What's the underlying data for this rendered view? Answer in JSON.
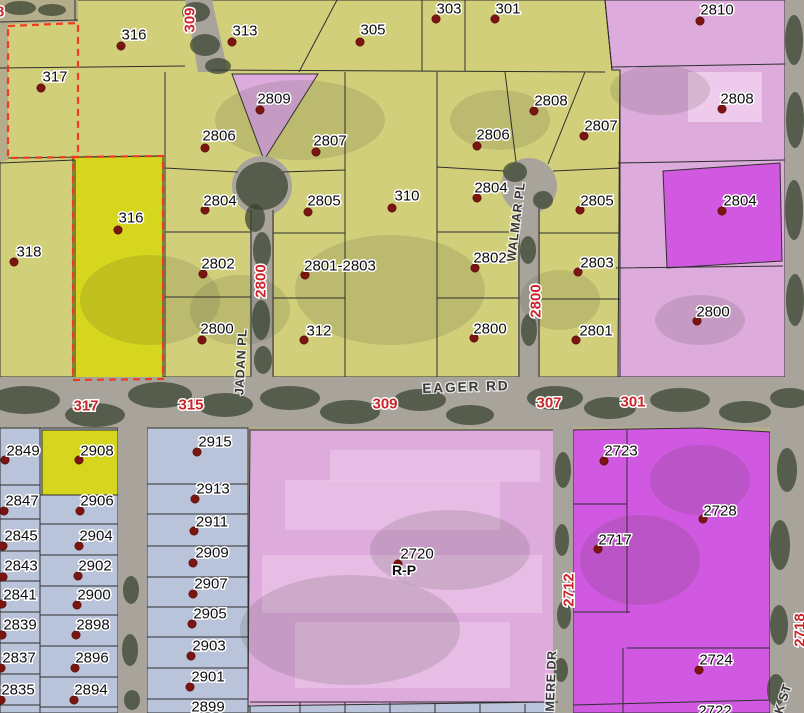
{
  "map": {
    "type": "gis-parcel-zoning-map",
    "colors": {
      "yellow": "#d2cf7b",
      "bright-yellow": "#d5d61d",
      "pink": "#ddabdc",
      "light-pink": "#eecaec",
      "magenta": "#d158e0",
      "blue": "#b9c3d9",
      "road": "#a8a39b",
      "ground": "#b3ad8c",
      "tree": "#37422e",
      "boundary": "#2f2f2f",
      "selection": "#f03b22",
      "dot": "#7c1511",
      "label": "#0c0c0c",
      "road-label": "#c9252b",
      "street": "#383838"
    },
    "parcels": [
      {
        "n": "316",
        "c": "y",
        "x": 134,
        "y": 35,
        "dx": 121,
        "dy": 46
      },
      {
        "n": "313",
        "c": "y",
        "x": 245,
        "y": 31,
        "dx": 232,
        "dy": 42
      },
      {
        "n": "305",
        "c": "y",
        "x": 373,
        "y": 30,
        "dx": 360,
        "dy": 42
      },
      {
        "n": "303",
        "c": "y",
        "x": 449,
        "y": 9,
        "dx": 436,
        "dy": 19
      },
      {
        "n": "301",
        "c": "y",
        "x": 508,
        "y": 9,
        "dx": 495,
        "dy": 19
      },
      {
        "n": "317",
        "c": "y",
        "x": 55,
        "y": 77,
        "dx": 41,
        "dy": 88
      },
      {
        "n": "318",
        "c": "y",
        "x": 29,
        "y": 252,
        "dx": 14,
        "dy": 262
      },
      {
        "n": "316",
        "c": "by",
        "x": 131,
        "y": 218,
        "dx": 118,
        "dy": 230
      },
      {
        "n": "2806",
        "c": "y",
        "x": 219,
        "y": 136,
        "dx": 205,
        "dy": 148
      },
      {
        "n": "2809",
        "c": "p",
        "x": 274,
        "y": 99,
        "dx": 260,
        "dy": 110
      },
      {
        "n": "2807",
        "c": "y",
        "x": 330,
        "y": 141,
        "dx": 316,
        "dy": 152
      },
      {
        "n": "2804",
        "c": "y",
        "x": 220,
        "y": 201,
        "dx": 205,
        "dy": 210
      },
      {
        "n": "2805",
        "c": "y",
        "x": 324,
        "y": 201,
        "dx": 308,
        "dy": 212
      },
      {
        "n": "310",
        "c": "y",
        "x": 407,
        "y": 196,
        "dx": 392,
        "dy": 208
      },
      {
        "n": "2802",
        "c": "y",
        "x": 218,
        "y": 264,
        "dx": 203,
        "dy": 274
      },
      {
        "n": "2801-2803",
        "c": "y",
        "x": 340,
        "y": 266,
        "dx": 305,
        "dy": 275
      },
      {
        "n": "2800",
        "c": "y",
        "x": 217,
        "y": 329,
        "dx": 202,
        "dy": 340
      },
      {
        "n": "312",
        "c": "y",
        "x": 319,
        "y": 331,
        "dx": 304,
        "dy": 340
      },
      {
        "n": "2806",
        "c": "y",
        "x": 493,
        "y": 135,
        "dx": 477,
        "dy": 146
      },
      {
        "n": "2808",
        "c": "y",
        "x": 551,
        "y": 101,
        "dx": 534,
        "dy": 111
      },
      {
        "n": "2807",
        "c": "y",
        "x": 601,
        "y": 126,
        "dx": 584,
        "dy": 136
      },
      {
        "n": "2804",
        "c": "y",
        "x": 491,
        "y": 188,
        "dx": 477,
        "dy": 198
      },
      {
        "n": "2805",
        "c": "y",
        "x": 597,
        "y": 201,
        "dx": 580,
        "dy": 210
      },
      {
        "n": "2802",
        "c": "y",
        "x": 490,
        "y": 258,
        "dx": 475,
        "dy": 268
      },
      {
        "n": "2803",
        "c": "y",
        "x": 597,
        "y": 263,
        "dx": 578,
        "dy": 272
      },
      {
        "n": "2800",
        "c": "y",
        "x": 490,
        "y": 329,
        "dx": 474,
        "dy": 338
      },
      {
        "n": "2801",
        "c": "y",
        "x": 596,
        "y": 331,
        "dx": 576,
        "dy": 340
      },
      {
        "n": "2810",
        "c": "p",
        "x": 717,
        "y": 10,
        "dx": 700,
        "dy": 21
      },
      {
        "n": "2808",
        "c": "p",
        "x": 737,
        "y": 99,
        "dx": 722,
        "dy": 109
      },
      {
        "n": "2804",
        "c": "m",
        "x": 740,
        "y": 201,
        "dx": 722,
        "dy": 211
      },
      {
        "n": "2800",
        "c": "p",
        "x": 713,
        "y": 312,
        "dx": 697,
        "dy": 321
      },
      {
        "n": "2720",
        "c": "p",
        "x": 417,
        "y": 554,
        "dx": 398,
        "dy": 564
      },
      {
        "n": "R-P",
        "c": "z",
        "x": 404,
        "y": 570
      },
      {
        "n": "2723",
        "c": "m",
        "x": 621,
        "y": 451,
        "dx": 604,
        "dy": 461
      },
      {
        "n": "2728",
        "c": "m",
        "x": 720,
        "y": 511,
        "dx": 703,
        "dy": 519
      },
      {
        "n": "2717",
        "c": "m",
        "x": 615,
        "y": 540,
        "dx": 598,
        "dy": 549
      },
      {
        "n": "2724",
        "c": "m",
        "x": 716,
        "y": 660,
        "dx": 699,
        "dy": 670
      },
      {
        "n": "2722",
        "c": "m",
        "x": 715,
        "y": 711
      },
      {
        "n": "2849",
        "c": "b",
        "x": 23,
        "y": 451,
        "dx": 5,
        "dy": 460
      },
      {
        "n": "2847",
        "c": "b",
        "x": 22,
        "y": 501,
        "dx": 4,
        "dy": 511
      },
      {
        "n": "2845",
        "c": "b",
        "x": 21,
        "y": 536,
        "dx": 3,
        "dy": 546
      },
      {
        "n": "2843",
        "c": "b",
        "x": 21,
        "y": 566,
        "dx": 3,
        "dy": 577
      },
      {
        "n": "2841",
        "c": "b",
        "x": 20,
        "y": 595,
        "dx": 2,
        "dy": 604
      },
      {
        "n": "2839",
        "c": "b",
        "x": 20,
        "y": 625,
        "dx": 2,
        "dy": 635
      },
      {
        "n": "2837",
        "c": "b",
        "x": 19,
        "y": 658,
        "dx": 1,
        "dy": 668
      },
      {
        "n": "2835",
        "c": "b",
        "x": 18,
        "y": 690,
        "dx": 1,
        "dy": 700
      },
      {
        "n": "2908",
        "c": "by",
        "x": 97,
        "y": 451,
        "dx": 79,
        "dy": 460
      },
      {
        "n": "2906",
        "c": "b",
        "x": 97,
        "y": 501,
        "dx": 80,
        "dy": 511
      },
      {
        "n": "2904",
        "c": "b",
        "x": 96,
        "y": 536,
        "dx": 79,
        "dy": 546
      },
      {
        "n": "2902",
        "c": "b",
        "x": 95,
        "y": 566,
        "dx": 78,
        "dy": 576
      },
      {
        "n": "2900",
        "c": "b",
        "x": 94,
        "y": 595,
        "dx": 77,
        "dy": 605
      },
      {
        "n": "2898",
        "c": "b",
        "x": 93,
        "y": 625,
        "dx": 76,
        "dy": 635
      },
      {
        "n": "2896",
        "c": "b",
        "x": 92,
        "y": 658,
        "dx": 75,
        "dy": 668
      },
      {
        "n": "2894",
        "c": "b",
        "x": 91,
        "y": 690,
        "dx": 74,
        "dy": 700
      },
      {
        "n": "2915",
        "c": "b",
        "x": 215,
        "y": 442,
        "dx": 197,
        "dy": 452
      },
      {
        "n": "2913",
        "c": "b",
        "x": 213,
        "y": 489,
        "dx": 195,
        "dy": 499
      },
      {
        "n": "2911",
        "c": "b",
        "x": 212,
        "y": 522,
        "dx": 194,
        "dy": 531
      },
      {
        "n": "2909",
        "c": "b",
        "x": 212,
        "y": 553,
        "dx": 193,
        "dy": 563
      },
      {
        "n": "2907",
        "c": "b",
        "x": 211,
        "y": 584,
        "dx": 193,
        "dy": 594
      },
      {
        "n": "2905",
        "c": "b",
        "x": 210,
        "y": 614,
        "dx": 192,
        "dy": 624
      },
      {
        "n": "2903",
        "c": "b",
        "x": 209,
        "y": 646,
        "dx": 191,
        "dy": 656
      },
      {
        "n": "2901",
        "c": "b",
        "x": 208,
        "y": 677,
        "dx": 190,
        "dy": 687
      },
      {
        "n": "2899",
        "c": "b",
        "x": 208,
        "y": 707
      }
    ],
    "road_block_labels": [
      {
        "t": "8",
        "x": 0,
        "y": 12,
        "r": 0
      },
      {
        "t": "309",
        "x": 190,
        "y": 20,
        "r": -90
      },
      {
        "t": "2800",
        "x": 261,
        "y": 281,
        "r": -90
      },
      {
        "t": "2800",
        "x": 536,
        "y": 301,
        "r": -90
      },
      {
        "t": "317",
        "x": 86,
        "y": 406,
        "r": 0
      },
      {
        "t": "315",
        "x": 191,
        "y": 405,
        "r": 0
      },
      {
        "t": "309",
        "x": 385,
        "y": 404,
        "r": 0
      },
      {
        "t": "307",
        "x": 549,
        "y": 403,
        "r": 0
      },
      {
        "t": "301",
        "x": 633,
        "y": 402,
        "r": 0
      },
      {
        "t": "2712",
        "x": 569,
        "y": 590,
        "r": -90
      },
      {
        "t": "2718",
        "x": 800,
        "y": 630,
        "r": -90
      }
    ],
    "street_names": [
      {
        "t": "EAGER RD",
        "x": 466,
        "y": 387,
        "r": -2,
        "big": true
      },
      {
        "t": "WALMAR PL",
        "x": 516,
        "y": 222,
        "r": -83
      },
      {
        "t": "JADAN PL",
        "x": 241,
        "y": 362,
        "r": -87
      },
      {
        "t": "MERE DR",
        "x": 551,
        "y": 681,
        "r": -88
      },
      {
        "t": "K ST",
        "x": 783,
        "y": 699,
        "r": -72
      }
    ]
  }
}
